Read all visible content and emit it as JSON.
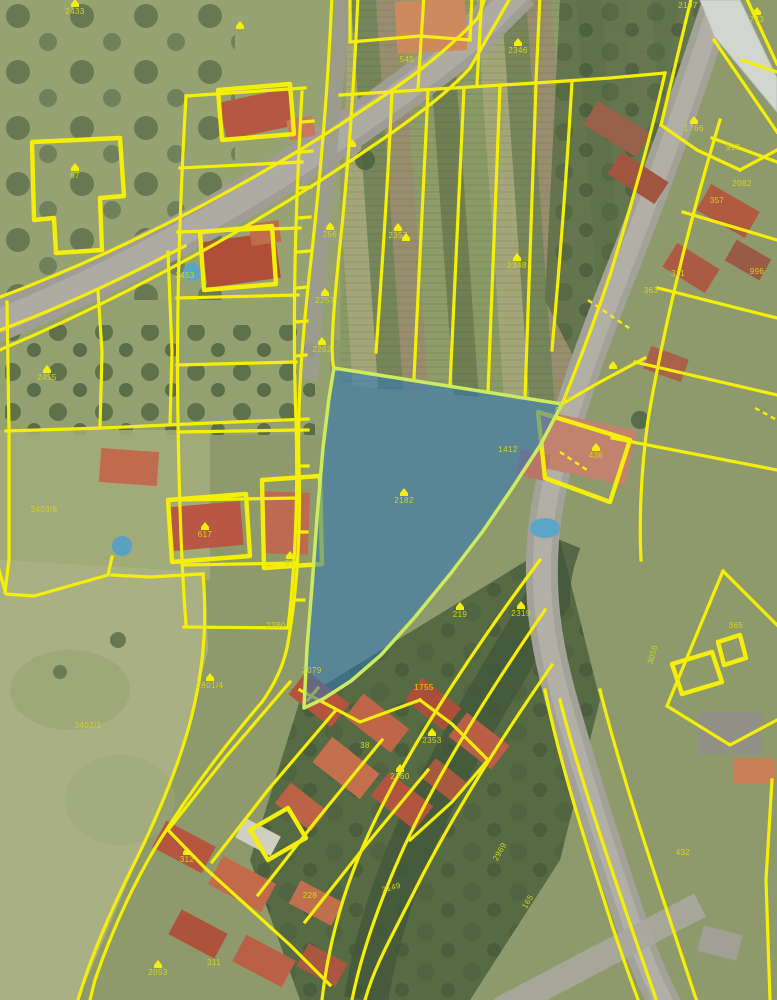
{
  "app": {
    "name": "cadastral aerial map view"
  },
  "map": {
    "kind": "aerial-photo-with-cadastral-overlay",
    "colors": {
      "boundary": "#f5ef08",
      "label": "#d4d41e",
      "highlight_fill": "#2b76b9",
      "highlight_stroke": "#cdeb5e",
      "road": "#a2a298",
      "field": "#8e9a6c"
    },
    "highlighted_parcel": {
      "number": "2182",
      "x": 404,
      "y": 503
    },
    "labels": [
      {
        "t": "2433",
        "x": 75,
        "y": 14,
        "i": true
      },
      {
        "t": "545",
        "x": 407,
        "y": 62
      },
      {
        "t": "2346",
        "x": 518,
        "y": 53,
        "i": true
      },
      {
        "t": "2197",
        "x": 688,
        "y": 8
      },
      {
        "t": "743",
        "x": 757,
        "y": 22,
        "i": true
      },
      {
        "t": "1766",
        "x": 694,
        "y": 131,
        "i": true
      },
      {
        "t": "997",
        "x": 733,
        "y": 150
      },
      {
        "t": "67",
        "x": 75,
        "y": 178,
        "i": true
      },
      {
        "t": "256",
        "x": 330,
        "y": 237,
        "i": true
      },
      {
        "t": "2357",
        "x": 398,
        "y": 238,
        "i": true
      },
      {
        "t": "2453",
        "x": 185,
        "y": 278
      },
      {
        "t": "2348",
        "x": 517,
        "y": 268,
        "i": true
      },
      {
        "t": "2257",
        "x": 325,
        "y": 303,
        "i": true
      },
      {
        "t": "2262",
        "x": 322,
        "y": 352,
        "i": true
      },
      {
        "t": "2455",
        "x": 47,
        "y": 380,
        "i": true
      },
      {
        "t": "2082",
        "x": 742,
        "y": 186
      },
      {
        "t": "357",
        "x": 717,
        "y": 203
      },
      {
        "t": "311",
        "x": 678,
        "y": 276
      },
      {
        "t": "363",
        "x": 651,
        "y": 293
      },
      {
        "t": "996",
        "x": 757,
        "y": 274
      },
      {
        "t": "2278",
        "x": 565,
        "y": 405,
        "r": -55
      },
      {
        "t": "1412",
        "x": 508,
        "y": 452
      },
      {
        "t": "436",
        "x": 596,
        "y": 458,
        "i": true
      },
      {
        "t": "2182",
        "x": 404,
        "y": 503,
        "i": true,
        "hg": true
      },
      {
        "t": "3403/8",
        "x": 44,
        "y": 512
      },
      {
        "t": "617",
        "x": 205,
        "y": 537,
        "i": true
      },
      {
        "t": "57",
        "x": 290,
        "y": 566,
        "i": true
      },
      {
        "t": "2280",
        "x": 276,
        "y": 628
      },
      {
        "t": "219",
        "x": 460,
        "y": 617,
        "i": true
      },
      {
        "t": "2319",
        "x": 521,
        "y": 616,
        "i": true
      },
      {
        "t": "2079",
        "x": 312,
        "y": 673
      },
      {
        "t": "3056",
        "x": 655,
        "y": 655,
        "r": -75
      },
      {
        "t": "365",
        "x": 736,
        "y": 628
      },
      {
        "t": "2601/4",
        "x": 210,
        "y": 688,
        "i": true
      },
      {
        "t": "1755",
        "x": 424,
        "y": 690
      },
      {
        "t": "3402/1",
        "x": 88,
        "y": 728
      },
      {
        "t": "2353",
        "x": 432,
        "y": 743,
        "i": true
      },
      {
        "t": "38",
        "x": 365,
        "y": 748
      },
      {
        "t": "2360",
        "x": 400,
        "y": 779,
        "i": true
      },
      {
        "t": "2969",
        "x": 502,
        "y": 853,
        "r": -60
      },
      {
        "t": "432",
        "x": 683,
        "y": 855
      },
      {
        "t": "312",
        "x": 187,
        "y": 862,
        "i": true
      },
      {
        "t": "3149",
        "x": 392,
        "y": 890,
        "r": -15
      },
      {
        "t": "228",
        "x": 310,
        "y": 898
      },
      {
        "t": "165",
        "x": 530,
        "y": 903,
        "r": -60
      },
      {
        "t": "311",
        "x": 214,
        "y": 965
      },
      {
        "t": "2053",
        "x": 158,
        "y": 975,
        "i": true
      },
      {
        "t": "",
        "x": 240,
        "y": 24,
        "i": true
      },
      {
        "t": "",
        "x": 352,
        "y": 142,
        "i": true
      },
      {
        "t": "",
        "x": 406,
        "y": 236,
        "i": true
      },
      {
        "t": "",
        "x": 613,
        "y": 364,
        "i": true
      }
    ]
  }
}
